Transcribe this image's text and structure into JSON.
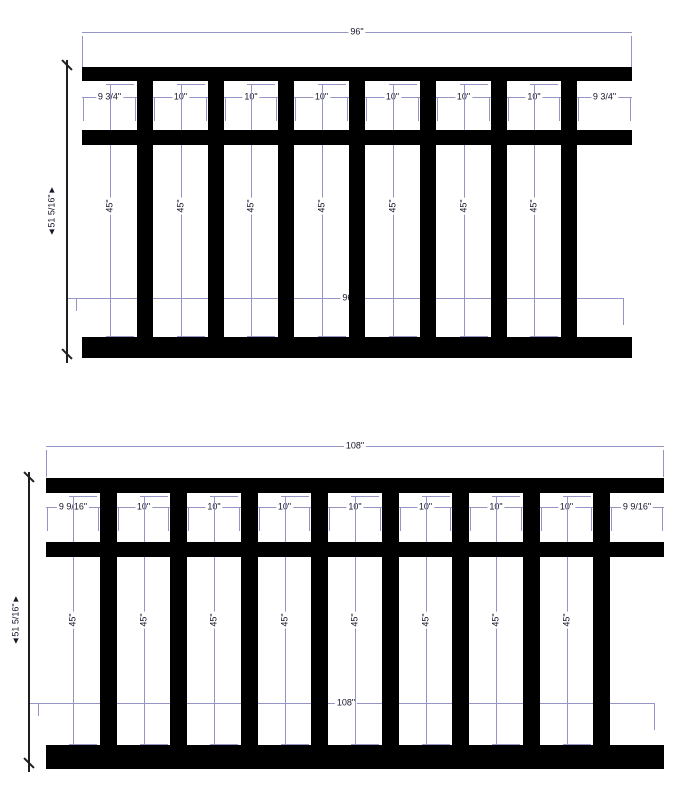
{
  "colors": {
    "dim_line": "#9494c6",
    "geometry": "#000000",
    "dim_text": "#15152b",
    "height_dim_line": "#1f1f1f"
  },
  "diagrams": [
    {
      "id": "railing-96",
      "overall_width_label": "96\"",
      "interior_width_label": "96\"",
      "overall_height_label": "◄51 5/16\"►",
      "picket_spacing_labels": [
        "9 3/4\"",
        "10\"",
        "10\"",
        "10\"",
        "10\"",
        "10\"",
        "10\"",
        "9 3/4\""
      ],
      "picket_height_labels": [
        "45\"",
        "45\"",
        "45\"",
        "45\"",
        "45\"",
        "45\"",
        "45\""
      ]
    },
    {
      "id": "railing-108",
      "overall_width_label": "108\"",
      "interior_width_label": "108\"",
      "overall_height_label": "◄51 5/16\"►",
      "picket_spacing_labels": [
        "9 9/16\"",
        "10\"",
        "10\"",
        "10\"",
        "10\"",
        "10\"",
        "10\"",
        "10\"",
        "9 9/16\""
      ],
      "picket_height_labels": [
        "45\"",
        "45\"",
        "45\"",
        "45\"",
        "45\"",
        "45\"",
        "45\"",
        "45\""
      ]
    }
  ]
}
